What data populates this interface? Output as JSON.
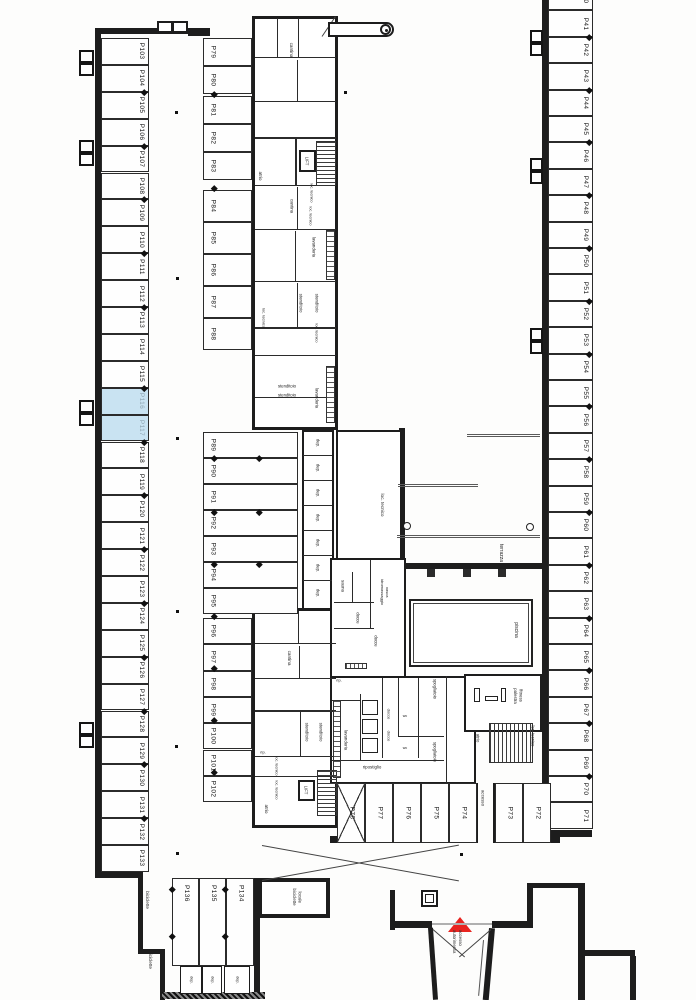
{
  "plan": {
    "title": "parking-level-floor-plan",
    "colors": {
      "line": "#1d1d1d",
      "paper": "#ffffff",
      "highlight": "#c9e3f2",
      "marker": "#e8241f"
    },
    "highlighted_stalls": [
      "P116",
      "P117"
    ],
    "entry_marker": {
      "shape": "triangle",
      "color": "#e8241f",
      "label": "accesso\nautorimessa"
    },
    "stalls": {
      "left_column": [
        "P103",
        "P104",
        "P105",
        "P106",
        "P107",
        "P108",
        "P109",
        "P110",
        "P111",
        "P112",
        "P113",
        "P114",
        "P115",
        "P116",
        "P117",
        "P118",
        "P119",
        "P120",
        "P121",
        "P122",
        "P123",
        "P124",
        "P125",
        "P126",
        "P127",
        "P128",
        "P129",
        "P130",
        "P131",
        "P132",
        "P133"
      ],
      "inner_upper": [
        "P79",
        "P80",
        "P81",
        "P82",
        "P83",
        "P84",
        "P85",
        "P86",
        "P87",
        "P88"
      ],
      "inner_double": [
        "P89",
        "P90",
        "P91",
        "P92",
        "P93",
        "P94",
        "P95"
      ],
      "inner_lower": [
        "P96",
        "P97",
        "P98",
        "P99",
        "P100",
        "P101",
        "P102"
      ],
      "right_column": [
        "P40",
        "P41",
        "P42",
        "P43",
        "P44",
        "P45",
        "P46",
        "P47",
        "P48",
        "P49",
        "P50",
        "P51",
        "P52",
        "P53",
        "P54",
        "P55",
        "P56",
        "P57",
        "P58",
        "P59",
        "P60",
        "P61",
        "P62",
        "P63",
        "P64",
        "P65",
        "P66",
        "P67",
        "P68",
        "P69",
        "P70",
        "P71"
      ],
      "south_row_west": [
        "P78",
        "P77",
        "P76",
        "P75",
        "P74"
      ],
      "south_row_east": [
        "P73",
        "P72"
      ],
      "southwest_block": [
        "P136",
        "P135",
        "P134"
      ]
    },
    "storage": {
      "label": "dep.",
      "mid_count": 7,
      "south_count": 3
    },
    "rooms": [
      {
        "id": "cantina-1",
        "label": "cantina"
      },
      {
        "id": "atrio-1",
        "label": "atrio"
      },
      {
        "id": "lift-1",
        "label": "LIFT"
      },
      {
        "id": "loc-tecnico-1",
        "label": "loc. tecnico"
      },
      {
        "id": "loc-tecnico-2",
        "label": "loc. tecnico"
      },
      {
        "id": "cantina-3",
        "label": "cantina"
      },
      {
        "id": "lavanderia-1",
        "label": "lavanderia"
      },
      {
        "id": "stenditoio-1",
        "label": "stenditoio"
      },
      {
        "id": "stenditoio-2",
        "label": "stenditoio"
      },
      {
        "id": "loc-tecnico-3",
        "label": "loc. tecnico"
      },
      {
        "id": "loc-tecnico-8",
        "label": "loc. tecnico"
      },
      {
        "id": "stenditoio-3",
        "label": "stenditoio"
      },
      {
        "id": "stenditoio-4",
        "label": "stenditoio"
      },
      {
        "id": "lavanderia-2",
        "label": "lavanderia"
      },
      {
        "id": "cantina-2",
        "label": "cantina"
      },
      {
        "id": "stenditoio-5",
        "label": "stenditoio"
      },
      {
        "id": "stenditoio-6",
        "label": "stenditoio"
      },
      {
        "id": "rip-2",
        "label": "rip."
      },
      {
        "id": "loc-tecnico-6",
        "label": "loc. tecnico"
      },
      {
        "id": "loc-tecnico-7",
        "label": "loc. tecnico"
      },
      {
        "id": "atrio-3",
        "label": "atrio"
      },
      {
        "id": "lift-2",
        "label": "LIFT"
      },
      {
        "id": "loc-tecnico-4",
        "label": "loc. tecnico"
      },
      {
        "id": "terrazza",
        "label": "terrazza"
      },
      {
        "id": "piscina",
        "label": "piscina"
      },
      {
        "id": "sauna",
        "label": "sauna"
      },
      {
        "id": "vasca",
        "label": "vasca idromassaggio"
      },
      {
        "id": "docce-1",
        "label": "docce"
      },
      {
        "id": "docce-2",
        "label": "docce"
      },
      {
        "id": "fitness",
        "label": "fitness palestra"
      },
      {
        "id": "spogliatoio-1",
        "label": "spogliatoio"
      },
      {
        "id": "docce-3",
        "label": "docce"
      },
      {
        "id": "docce-4",
        "label": "docce"
      },
      {
        "id": "wc-1",
        "label": "wc"
      },
      {
        "id": "wc-2",
        "label": "wc"
      },
      {
        "id": "spogliatoio-2",
        "label": "spogliatoio"
      },
      {
        "id": "ripostiglio",
        "label": "ripostiglio"
      },
      {
        "id": "lavanderia-3",
        "label": "lavanderia"
      },
      {
        "id": "rip-1",
        "label": "rip."
      },
      {
        "id": "atrio-2",
        "label": "atrio"
      },
      {
        "id": "loc-tecnico-5",
        "label": "loc. tecnico"
      },
      {
        "id": "accesso",
        "label": "accesso"
      },
      {
        "id": "locale-biciclette",
        "label": "locale biciclette"
      },
      {
        "id": "biciclette-1",
        "label": "biciclette"
      },
      {
        "id": "biciclette-2",
        "label": "biciclette"
      }
    ]
  }
}
